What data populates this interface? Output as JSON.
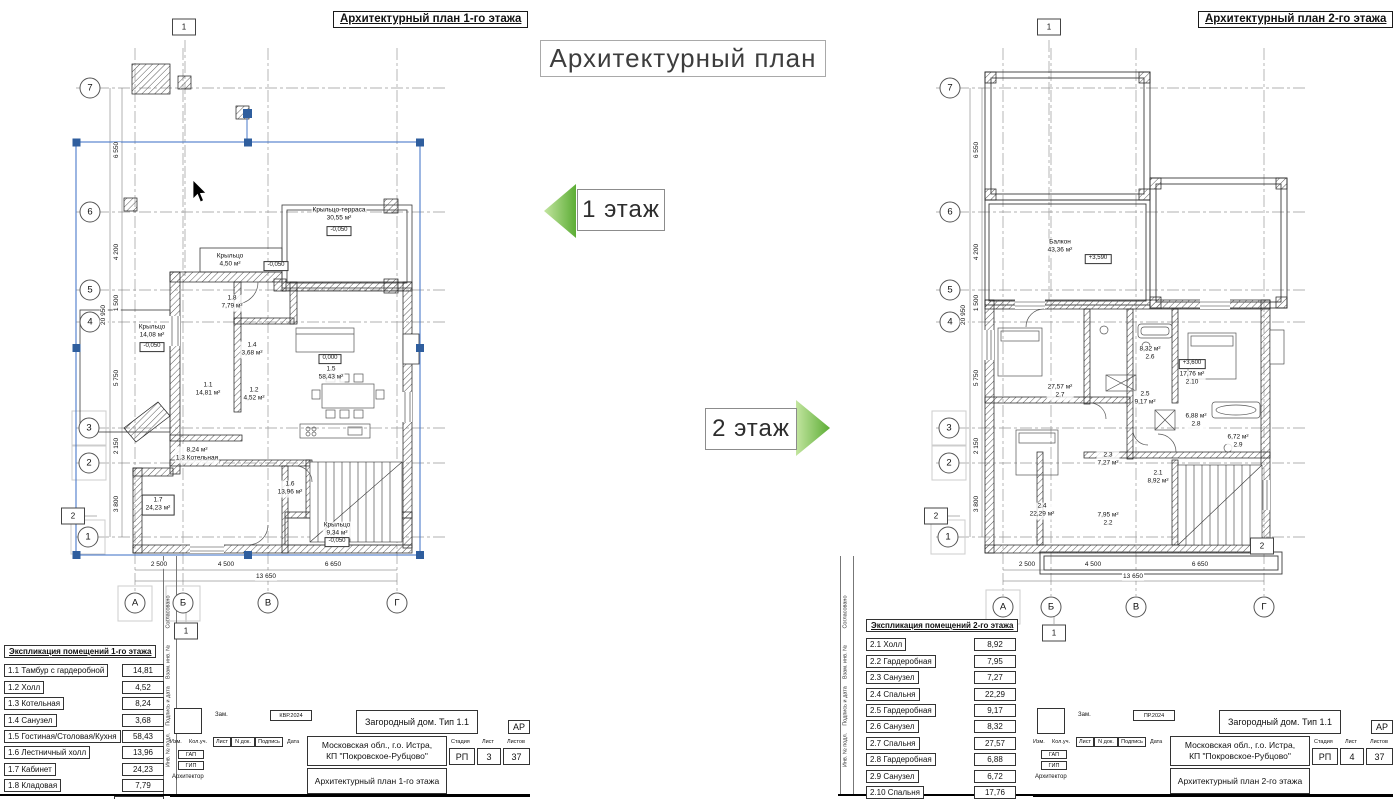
{
  "page": {
    "main_title": "Архитектурный план",
    "floor1_tag": "1 этаж",
    "floor2_tag": "2 этаж",
    "colors": {
      "arrow_green_light": "#c3e5a0",
      "arrow_green_dark": "#5cad35",
      "selection_blue": "#4a79c9",
      "handle_blue": "#2f5e9e"
    }
  },
  "stamp_column": [
    "Согласовано",
    "Взам. инв. №",
    "Подпись и дата",
    "Инв. № подл."
  ],
  "sheet1": {
    "header": "Архитектурный план 1-го этажа",
    "explication": {
      "title": "Экспликация помещений 1-го этажа",
      "rows": [
        {
          "name": "1.1 Тамбур с гардеробной",
          "area": "14,81"
        },
        {
          "name": "1.2 Холл",
          "area": "4,52"
        },
        {
          "name": "1.3 Котельная",
          "area": "8,24"
        },
        {
          "name": "1.4 Санузел",
          "area": "3,68"
        },
        {
          "name": "1.5 Гостиная/Столовая/Кухня",
          "area": "58,43"
        },
        {
          "name": "1.6 Лестничный холл",
          "area": "13,96"
        },
        {
          "name": "1.7 Кабинет",
          "area": "24,23"
        },
        {
          "name": "1.8 Кладовая",
          "area": "7,79"
        }
      ],
      "total": "135,66 м²"
    },
    "titleblock": {
      "project": "Загородный дом. Тип 1.1",
      "code": "АР",
      "address_line1": "Московская обл., г.о. Истра,",
      "address_line2": "КП \"Покровское-Рубцово\"",
      "drawing": "Архитектурный план 1-го этажа",
      "stage_label": "Стадия",
      "stage": "РП",
      "sheet_label": "Лист",
      "sheet": "3",
      "sheets_label": "Листов",
      "sheets": "37",
      "rev_label": "Зам.",
      "doc_code": "КВР.2024",
      "cols": [
        "Изм.",
        "Кол.уч.",
        "Лист",
        "N док.",
        "Подпись",
        "Дата"
      ],
      "roles": [
        "ГАП",
        "ГИП",
        "Архитектор"
      ]
    },
    "plan": {
      "labels": [
        {
          "c": "bub",
          "x": 90,
          "y": 88,
          "t": "7"
        },
        {
          "c": "bub",
          "x": 90,
          "y": 212,
          "t": "6"
        },
        {
          "c": "bub",
          "x": 90,
          "y": 290,
          "t": "5"
        },
        {
          "c": "bub",
          "x": 90,
          "y": 322,
          "t": "4"
        },
        {
          "c": "bub",
          "x": 89,
          "y": 428,
          "t": "3"
        },
        {
          "c": "bub",
          "x": 89,
          "y": 463,
          "t": "2"
        },
        {
          "c": "bub",
          "x": 88,
          "y": 537,
          "t": "1"
        },
        {
          "c": "bub",
          "x": 135,
          "y": 603,
          "t": "А"
        },
        {
          "c": "bub",
          "x": 183,
          "y": 603,
          "t": "Б"
        },
        {
          "c": "bub",
          "x": 268,
          "y": 603,
          "t": "В"
        },
        {
          "c": "bub",
          "x": 397,
          "y": 603,
          "t": "Г"
        },
        {
          "c": "flagnum",
          "x": 184,
          "y": 27,
          "t": "1"
        },
        {
          "c": "flagnum",
          "x": 73,
          "y": 516,
          "t": "2"
        },
        {
          "c": "flagnum",
          "x": 186,
          "y": 631,
          "t": "1"
        },
        {
          "c": "dim",
          "x": 159,
          "y": 565,
          "t": "2 500"
        },
        {
          "c": "dim",
          "x": 226,
          "y": 565,
          "t": "4 500"
        },
        {
          "c": "dim",
          "x": 333,
          "y": 565,
          "t": "6 650"
        },
        {
          "c": "dim",
          "x": 266,
          "y": 577,
          "t": "13 650"
        },
        {
          "c": "dimv",
          "x": 117,
          "y": 150,
          "t": "6 550"
        },
        {
          "c": "dimv",
          "x": 117,
          "y": 252,
          "t": "4 200"
        },
        {
          "c": "dimv",
          "x": 117,
          "y": 303,
          "t": "1 500"
        },
        {
          "c": "dimv",
          "x": 104,
          "y": 315,
          "t": "20 950"
        },
        {
          "c": "dimv",
          "x": 117,
          "y": 378,
          "t": "5 750"
        },
        {
          "c": "dimv",
          "x": 117,
          "y": 446,
          "t": "2 150"
        },
        {
          "c": "dimv",
          "x": 117,
          "y": 504,
          "t": "3 800"
        },
        {
          "c": "room",
          "x": 339,
          "y": 215,
          "t": [
            "Крыльцо-терраса",
            "30,55 м²"
          ]
        },
        {
          "c": "lvl",
          "x": 339,
          "y": 231,
          "t": "-0,050"
        },
        {
          "c": "room",
          "x": 230,
          "y": 261,
          "t": [
            "Крыльцо",
            "4,50 м²"
          ]
        },
        {
          "c": "lvl",
          "x": 276,
          "y": 266,
          "t": "-0,050"
        },
        {
          "c": "room",
          "x": 232,
          "y": 303,
          "t": [
            "1.8",
            "7,79 м²"
          ]
        },
        {
          "c": "room",
          "x": 152,
          "y": 332,
          "t": [
            "Крыльцо",
            "14,08 м²"
          ]
        },
        {
          "c": "lvl",
          "x": 152,
          "y": 347,
          "t": "-0,050"
        },
        {
          "c": "room",
          "x": 252,
          "y": 350,
          "t": [
            "1.4",
            "3,68 м²"
          ]
        },
        {
          "c": "lvl",
          "x": 330,
          "y": 359,
          "t": "0,000"
        },
        {
          "c": "room",
          "x": 331,
          "y": 374,
          "t": [
            "1.5",
            "58,43 м²"
          ]
        },
        {
          "c": "room",
          "x": 208,
          "y": 390,
          "t": [
            "1.1",
            "14,81 м²"
          ]
        },
        {
          "c": "room",
          "x": 254,
          "y": 395,
          "t": [
            "1.2",
            "4,52 м²"
          ]
        },
        {
          "c": "room",
          "x": 197,
          "y": 455,
          "t": [
            "8,24 м²",
            "1.3 Котельная"
          ]
        },
        {
          "c": "roombox",
          "x": 158,
          "y": 505,
          "t": [
            "1.7",
            "24,23 м²"
          ]
        },
        {
          "c": "room",
          "x": 290,
          "y": 489,
          "t": [
            "1.6",
            "13,96 м²"
          ]
        },
        {
          "c": "room",
          "x": 337,
          "y": 530,
          "t": [
            "Крыльцо",
            "9,34 м²"
          ]
        },
        {
          "c": "lvl",
          "x": 337,
          "y": 542,
          "t": "-0,050"
        },
        {
          "c": "stamp",
          "x": 169,
          "y": 612,
          "t": "Согласовано"
        },
        {
          "c": "stamp",
          "x": 169,
          "y": 662,
          "t": "Взам. инв. №"
        },
        {
          "c": "stamp",
          "x": 169,
          "y": 706,
          "t": "Подпись и дата"
        },
        {
          "c": "stamp",
          "x": 169,
          "y": 750,
          "t": "Инв. № подл."
        }
      ]
    }
  },
  "sheet2": {
    "header": "Архитектурный план 2-го этажа",
    "explication": {
      "title": "Экспликация помещений 2-го этажа",
      "rows": [
        {
          "name": "2.1 Холл",
          "area": "8,92"
        },
        {
          "name": "2.2 Гардеробная",
          "area": "7,95"
        },
        {
          "name": "2.3 Санузел",
          "area": "7,27"
        },
        {
          "name": "2.4 Спальня",
          "area": "22,29"
        },
        {
          "name": "2.5 Гардеробная",
          "area": "9,17"
        },
        {
          "name": "2.6 Санузел",
          "area": "8,32"
        },
        {
          "name": "2.7 Спальня",
          "area": "27,57"
        },
        {
          "name": "2.8 Гардеробная",
          "area": "6,88"
        },
        {
          "name": "2.9 Санузел",
          "area": "6,72"
        },
        {
          "name": "2.10 Спальня",
          "area": "17,76"
        }
      ],
      "total": "122,55 м²"
    },
    "titleblock": {
      "project": "Загородный дом. Тип 1.1",
      "code": "АР",
      "address_line1": "Московская обл., г.о. Истра,",
      "address_line2": "КП \"Покровское-Рубцово\"",
      "drawing": "Архитектурный план 2-го этажа",
      "stage_label": "Стадия",
      "stage": "РП",
      "sheet_label": "Лист",
      "sheet": "4",
      "sheets_label": "Листов",
      "sheets": "37",
      "rev_label": "Зам.",
      "doc_code": "ПР.2024",
      "cols": [
        "Изм.",
        "Кол.уч.",
        "Лист",
        "N док.",
        "Подпись",
        "Дата"
      ],
      "roles": [
        "ГАП",
        "ГИП",
        "Архитектор"
      ]
    },
    "plan": {
      "labels": [
        {
          "c": "bub",
          "x": 950,
          "y": 88,
          "t": "7"
        },
        {
          "c": "bub",
          "x": 950,
          "y": 212,
          "t": "6"
        },
        {
          "c": "bub",
          "x": 950,
          "y": 290,
          "t": "5"
        },
        {
          "c": "bub",
          "x": 950,
          "y": 322,
          "t": "4"
        },
        {
          "c": "bub",
          "x": 949,
          "y": 428,
          "t": "3"
        },
        {
          "c": "bub",
          "x": 949,
          "y": 463,
          "t": "2"
        },
        {
          "c": "bub",
          "x": 948,
          "y": 537,
          "t": "1"
        },
        {
          "c": "bub",
          "x": 1003,
          "y": 607,
          "t": "А"
        },
        {
          "c": "bub",
          "x": 1051,
          "y": 607,
          "t": "Б"
        },
        {
          "c": "bub",
          "x": 1136,
          "y": 607,
          "t": "В"
        },
        {
          "c": "bub",
          "x": 1264,
          "y": 607,
          "t": "Г"
        },
        {
          "c": "flagnum",
          "x": 1049,
          "y": 27,
          "t": "1"
        },
        {
          "c": "flagnum",
          "x": 936,
          "y": 516,
          "t": "2"
        },
        {
          "c": "flagnum",
          "x": 1054,
          "y": 633,
          "t": "1"
        },
        {
          "c": "flagnum",
          "x": 1262,
          "y": 546,
          "t": "2"
        },
        {
          "c": "dim",
          "x": 1027,
          "y": 565,
          "t": "2 500"
        },
        {
          "c": "dim",
          "x": 1093,
          "y": 565,
          "t": "4 500"
        },
        {
          "c": "dim",
          "x": 1200,
          "y": 565,
          "t": "6 650"
        },
        {
          "c": "dim",
          "x": 1133,
          "y": 577,
          "t": "13 650"
        },
        {
          "c": "dimv",
          "x": 977,
          "y": 150,
          "t": "6 550"
        },
        {
          "c": "dimv",
          "x": 977,
          "y": 252,
          "t": "4 200"
        },
        {
          "c": "dimv",
          "x": 977,
          "y": 303,
          "t": "1 500"
        },
        {
          "c": "dimv",
          "x": 964,
          "y": 315,
          "t": "20 950"
        },
        {
          "c": "dimv",
          "x": 977,
          "y": 378,
          "t": "5 750"
        },
        {
          "c": "dimv",
          "x": 977,
          "y": 446,
          "t": "2 150"
        },
        {
          "c": "dimv",
          "x": 977,
          "y": 504,
          "t": "3 800"
        },
        {
          "c": "room",
          "x": 1060,
          "y": 247,
          "t": [
            "Балкон",
            "43,36 м²"
          ]
        },
        {
          "c": "lvl",
          "x": 1098,
          "y": 259,
          "t": "+3,590"
        },
        {
          "c": "room",
          "x": 1150,
          "y": 354,
          "t": [
            "8,32 м²",
            "2.6"
          ]
        },
        {
          "c": "lvl",
          "x": 1192,
          "y": 364,
          "t": "+3,600"
        },
        {
          "c": "room",
          "x": 1192,
          "y": 379,
          "t": [
            "17,76 м²",
            "2.10"
          ]
        },
        {
          "c": "room",
          "x": 1060,
          "y": 392,
          "t": [
            "27,57 м²",
            "2.7"
          ]
        },
        {
          "c": "room",
          "x": 1145,
          "y": 399,
          "t": [
            "2.5",
            "9,17 м²"
          ]
        },
        {
          "c": "room",
          "x": 1196,
          "y": 421,
          "t": [
            "6,88 м²",
            "2.8"
          ]
        },
        {
          "c": "room",
          "x": 1238,
          "y": 442,
          "t": [
            "6,72 м²",
            "2.9"
          ]
        },
        {
          "c": "room",
          "x": 1108,
          "y": 460,
          "t": [
            "2.3",
            "7,27 м²"
          ]
        },
        {
          "c": "room",
          "x": 1158,
          "y": 478,
          "t": [
            "2.1",
            "8,92 м²"
          ]
        },
        {
          "c": "room",
          "x": 1042,
          "y": 511,
          "t": [
            "2.4",
            "22,29 м²"
          ]
        },
        {
          "c": "room",
          "x": 1108,
          "y": 520,
          "t": [
            "7,95 м²",
            "2.2"
          ]
        },
        {
          "c": "stamp",
          "x": 846,
          "y": 612,
          "t": "Согласовано"
        },
        {
          "c": "stamp",
          "x": 846,
          "y": 662,
          "t": "Взам. инв. №"
        },
        {
          "c": "stamp",
          "x": 846,
          "y": 706,
          "t": "Подпись и дата"
        },
        {
          "c": "stamp",
          "x": 846,
          "y": 750,
          "t": "Инв. № подл."
        }
      ]
    }
  }
}
